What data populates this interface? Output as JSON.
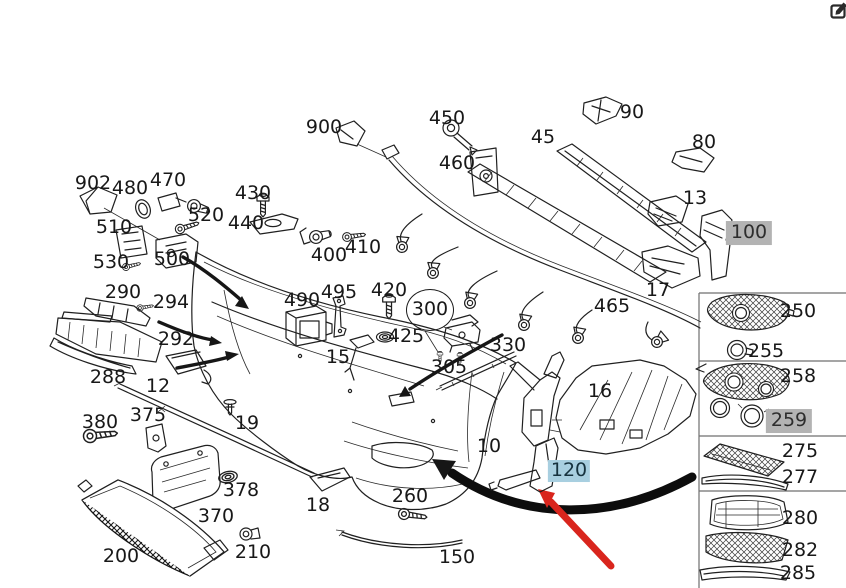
{
  "page": {
    "background": "#ffffff",
    "description": "Exploded parts diagram of a car front bumper assembly with numbered callouts"
  },
  "colors": {
    "line": "#202020",
    "highlight_gray": "#b3b3b3",
    "highlight_blue": "#a8cfe0",
    "arrow_black": "#0d0d0d",
    "arrow_red": "#d9251d",
    "panel_frame": "#6f6f6f"
  },
  "icons": {
    "top_right": "edit-compose-icon"
  },
  "annotations": {
    "black_swoosh_arrow": "curved arrow pointing to lower-left of bumper",
    "red_arrow": "red arrow pointing to highlighted bracket 120",
    "circled_part": "300",
    "gray_highlighted_parts": [
      "100",
      "259"
    ],
    "blue_highlighted_parts": [
      "120"
    ]
  },
  "panel": {
    "rows": [
      [
        "250",
        "255"
      ],
      [
        "258",
        "259"
      ],
      [
        "275",
        "277"
      ],
      [
        "280",
        "282",
        "285"
      ]
    ]
  },
  "diagram": {
    "labels": [
      {
        "text": "902",
        "x": 93,
        "y": 184
      },
      {
        "text": "480",
        "x": 130,
        "y": 189
      },
      {
        "text": "470",
        "x": 168,
        "y": 181
      },
      {
        "text": "510",
        "x": 114,
        "y": 228
      },
      {
        "text": "520",
        "x": 206,
        "y": 216
      },
      {
        "text": "530",
        "x": 111,
        "y": 263
      },
      {
        "text": "500",
        "x": 172,
        "y": 260
      },
      {
        "text": "430",
        "x": 253,
        "y": 194
      },
      {
        "text": "440",
        "x": 246,
        "y": 224
      },
      {
        "text": "900",
        "x": 324,
        "y": 128
      },
      {
        "text": "450",
        "x": 447,
        "y": 119
      },
      {
        "text": "460",
        "x": 457,
        "y": 164
      },
      {
        "text": "400",
        "x": 329,
        "y": 256
      },
      {
        "text": "410",
        "x": 363,
        "y": 248
      },
      {
        "text": "45",
        "x": 543,
        "y": 138
      },
      {
        "text": "90",
        "x": 632,
        "y": 113
      },
      {
        "text": "80",
        "x": 704,
        "y": 143
      },
      {
        "text": "13",
        "x": 695,
        "y": 199
      },
      {
        "text": "100",
        "x": 749,
        "y": 233,
        "style": "gray"
      },
      {
        "text": "17",
        "x": 658,
        "y": 291
      },
      {
        "text": "465",
        "x": 612,
        "y": 307
      },
      {
        "text": "290",
        "x": 123,
        "y": 293
      },
      {
        "text": "294",
        "x": 171,
        "y": 303
      },
      {
        "text": "292",
        "x": 176,
        "y": 340
      },
      {
        "text": "288",
        "x": 108,
        "y": 378
      },
      {
        "text": "12",
        "x": 158,
        "y": 387
      },
      {
        "text": "490",
        "x": 302,
        "y": 301
      },
      {
        "text": "495",
        "x": 339,
        "y": 293
      },
      {
        "text": "420",
        "x": 389,
        "y": 291
      },
      {
        "text": "425",
        "x": 406,
        "y": 337
      },
      {
        "text": "300",
        "x": 430,
        "y": 310,
        "style": "circle"
      },
      {
        "text": "305",
        "x": 449,
        "y": 368
      },
      {
        "text": "15",
        "x": 338,
        "y": 358
      },
      {
        "text": "330",
        "x": 508,
        "y": 346
      },
      {
        "text": "16",
        "x": 600,
        "y": 392
      },
      {
        "text": "10",
        "x": 489,
        "y": 447
      },
      {
        "text": "120",
        "x": 569,
        "y": 471,
        "style": "blue"
      },
      {
        "text": "380",
        "x": 100,
        "y": 423
      },
      {
        "text": "375",
        "x": 148,
        "y": 416
      },
      {
        "text": "19",
        "x": 247,
        "y": 424
      },
      {
        "text": "378",
        "x": 241,
        "y": 491
      },
      {
        "text": "370",
        "x": 216,
        "y": 517
      },
      {
        "text": "18",
        "x": 318,
        "y": 506
      },
      {
        "text": "200",
        "x": 121,
        "y": 557
      },
      {
        "text": "210",
        "x": 253,
        "y": 553
      },
      {
        "text": "260",
        "x": 410,
        "y": 497
      },
      {
        "text": "150",
        "x": 457,
        "y": 558
      },
      {
        "text": "250",
        "x": 798,
        "y": 312
      },
      {
        "text": "255",
        "x": 766,
        "y": 352
      },
      {
        "text": "258",
        "x": 798,
        "y": 377
      },
      {
        "text": "259",
        "x": 789,
        "y": 421,
        "style": "gray"
      },
      {
        "text": "275",
        "x": 800,
        "y": 452
      },
      {
        "text": "277",
        "x": 800,
        "y": 478
      },
      {
        "text": "280",
        "x": 800,
        "y": 519
      },
      {
        "text": "282",
        "x": 800,
        "y": 551
      },
      {
        "text": "285",
        "x": 798,
        "y": 574
      }
    ]
  }
}
